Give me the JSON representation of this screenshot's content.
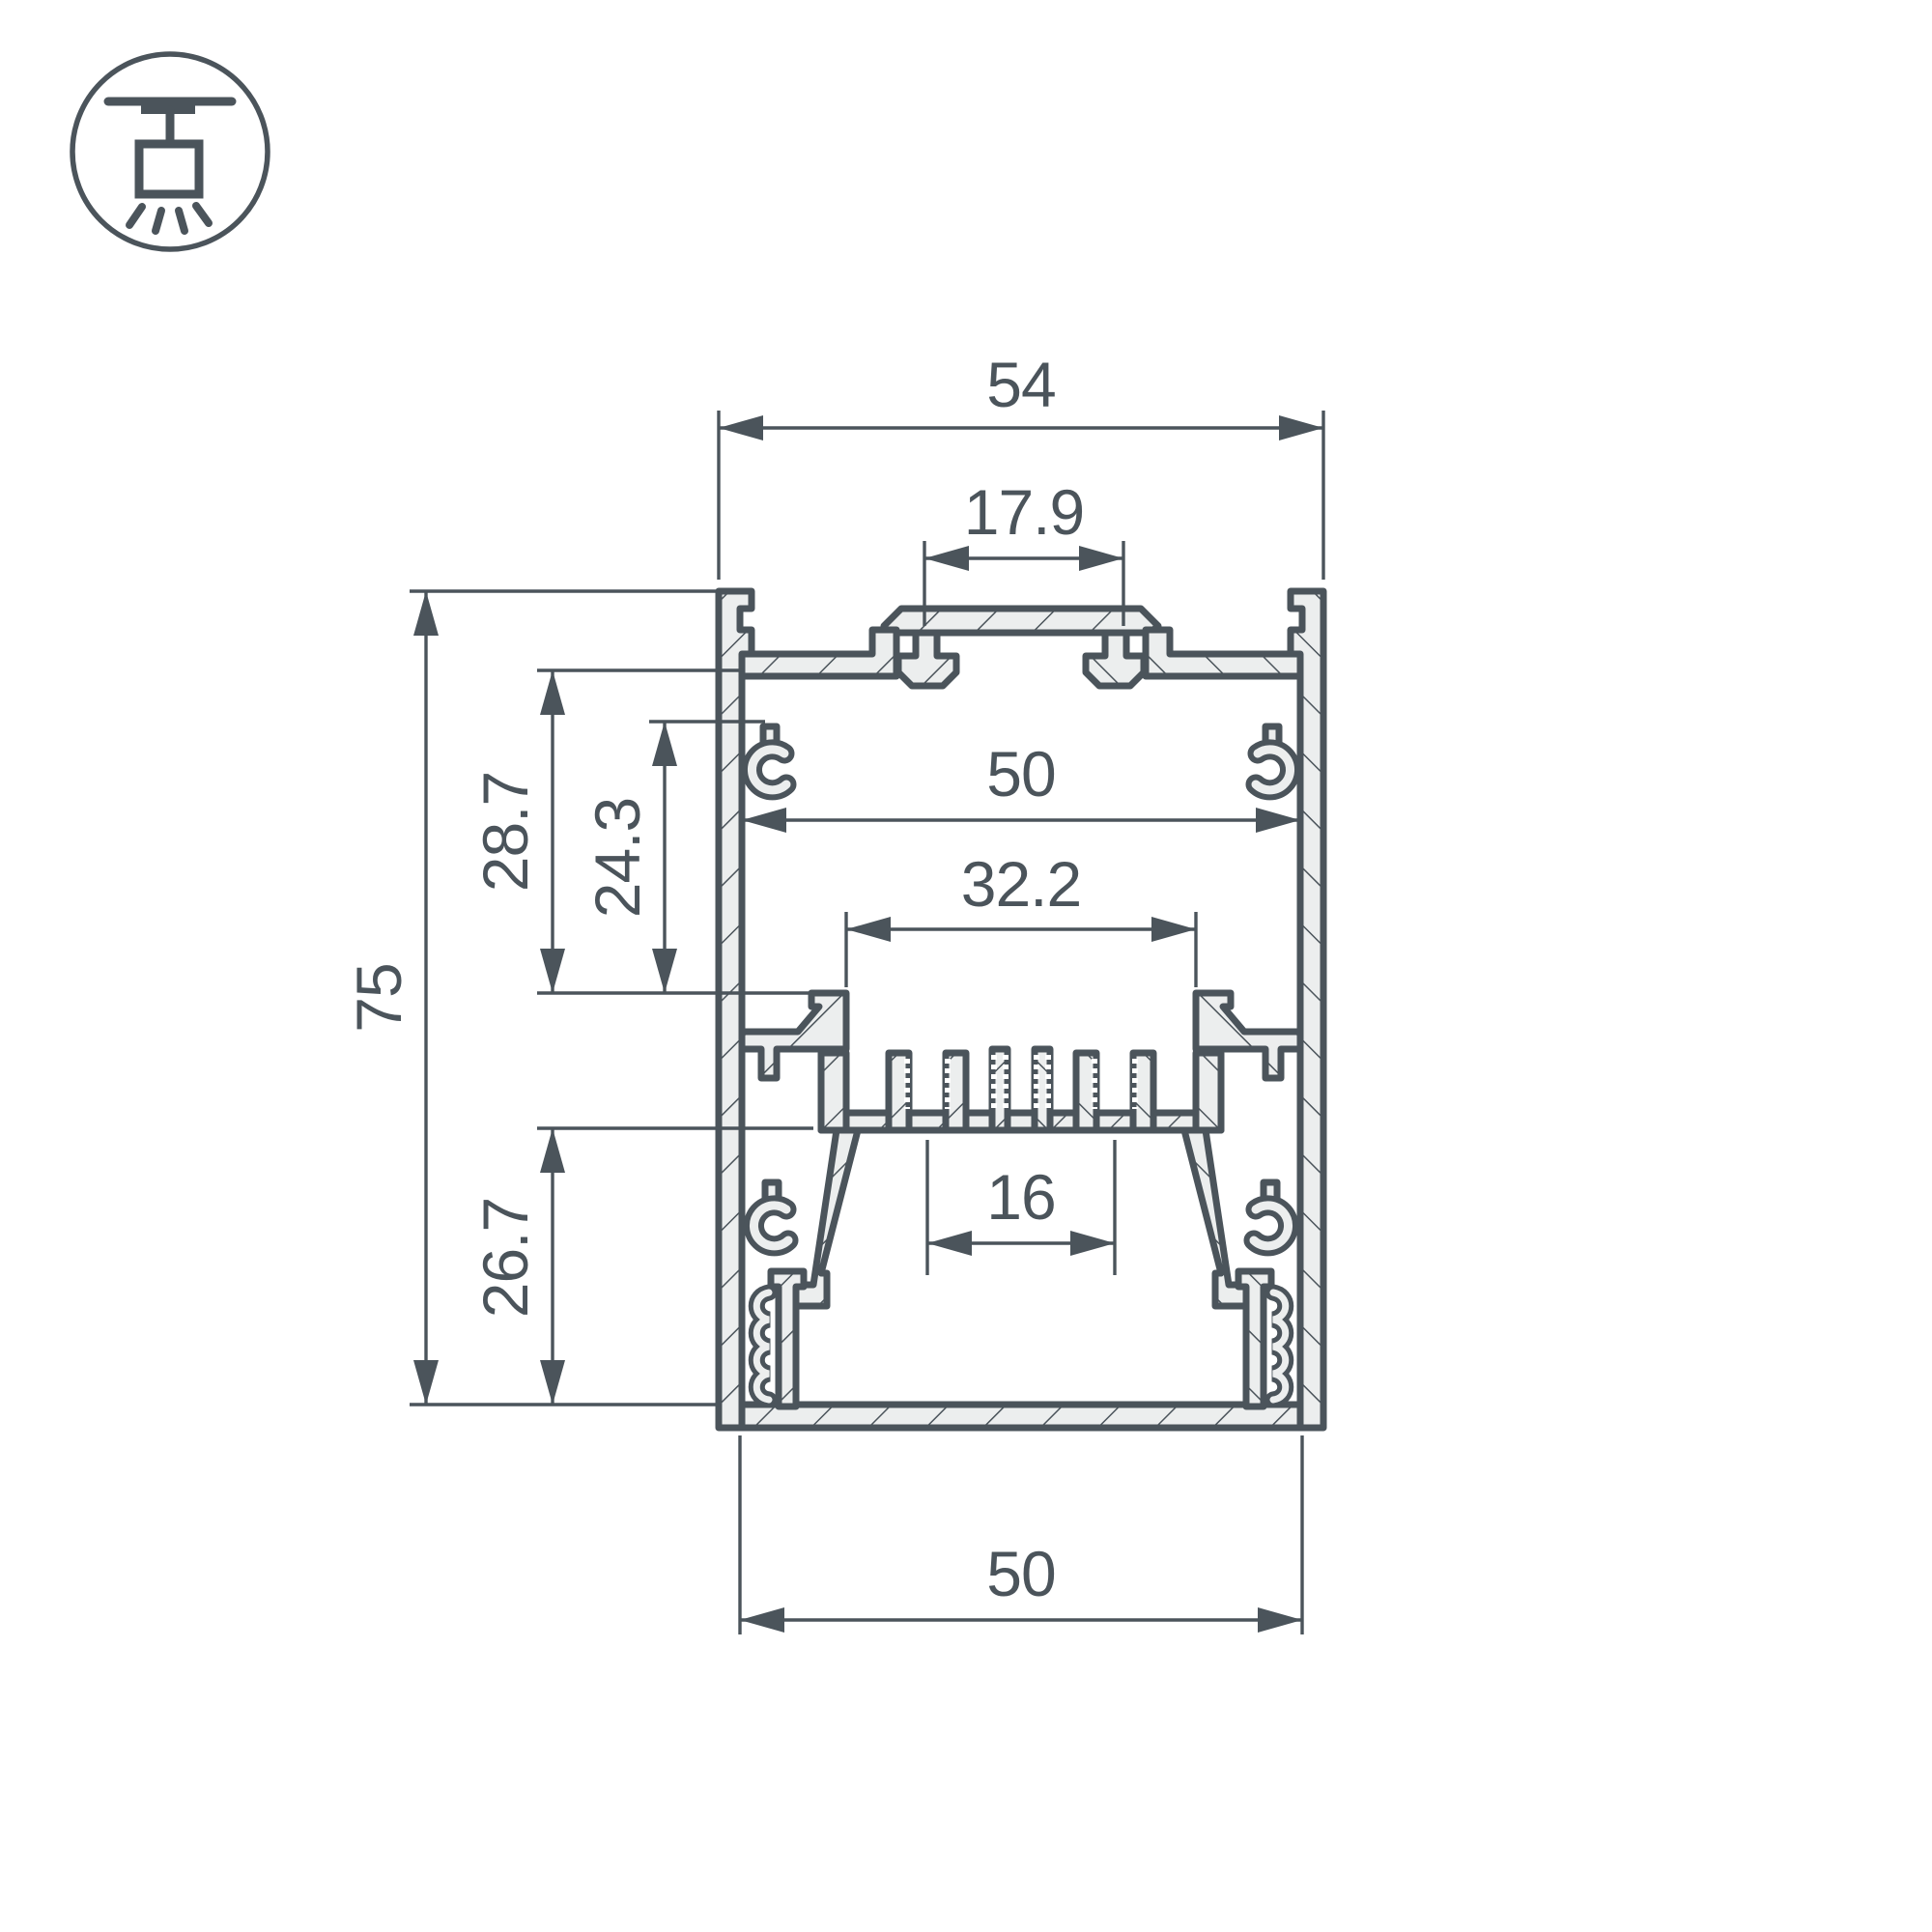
{
  "colors": {
    "line": "#4b545b",
    "material_fill": "#eceeee",
    "background": "#ffffff"
  },
  "icon": {
    "name": "pendant-ceiling-mount",
    "description": "suspended luminaire mounting symbol"
  },
  "drawing": {
    "type": "extrusion-profile-cross-section",
    "dimensions": {
      "outer_width": "54",
      "top_slot_width": "17.9",
      "inner_width": "50",
      "bracket_opening_width": "32.2",
      "screw_channel_spacing": "16",
      "bottom_width": "50",
      "overall_height": "75",
      "upper_cavity_depth": "28.7",
      "mount_plate_depth": "24.3",
      "lower_cavity_depth": "26.7"
    }
  }
}
